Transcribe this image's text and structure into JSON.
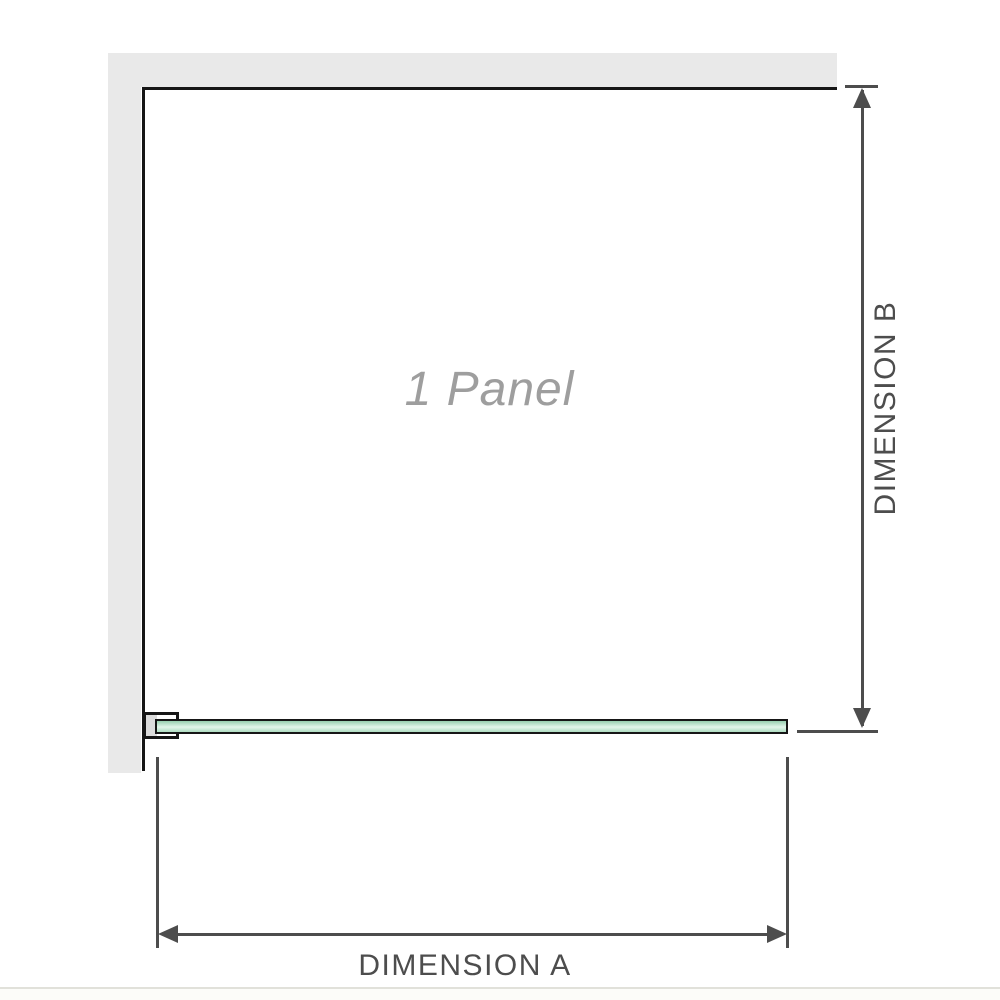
{
  "diagram": {
    "panel_label": "1 Panel",
    "dimension_a_label": "DIMENSION A",
    "dimension_b_label": "DIMENSION B"
  },
  "colors": {
    "wall": "#e9e9e9",
    "outline": "#161616",
    "dimension": "#4d4d4d",
    "label": "#4d4d4d",
    "watermark": "#9e9e9e",
    "glass_top": "#96cfae",
    "glass_mid": "#e2f5ea",
    "glass_bottom": "#aeddc1",
    "bracket_pad": "#dcdcdc",
    "page_edge": "#e1e1da",
    "page_edge_fill": "#fcfcf9"
  }
}
